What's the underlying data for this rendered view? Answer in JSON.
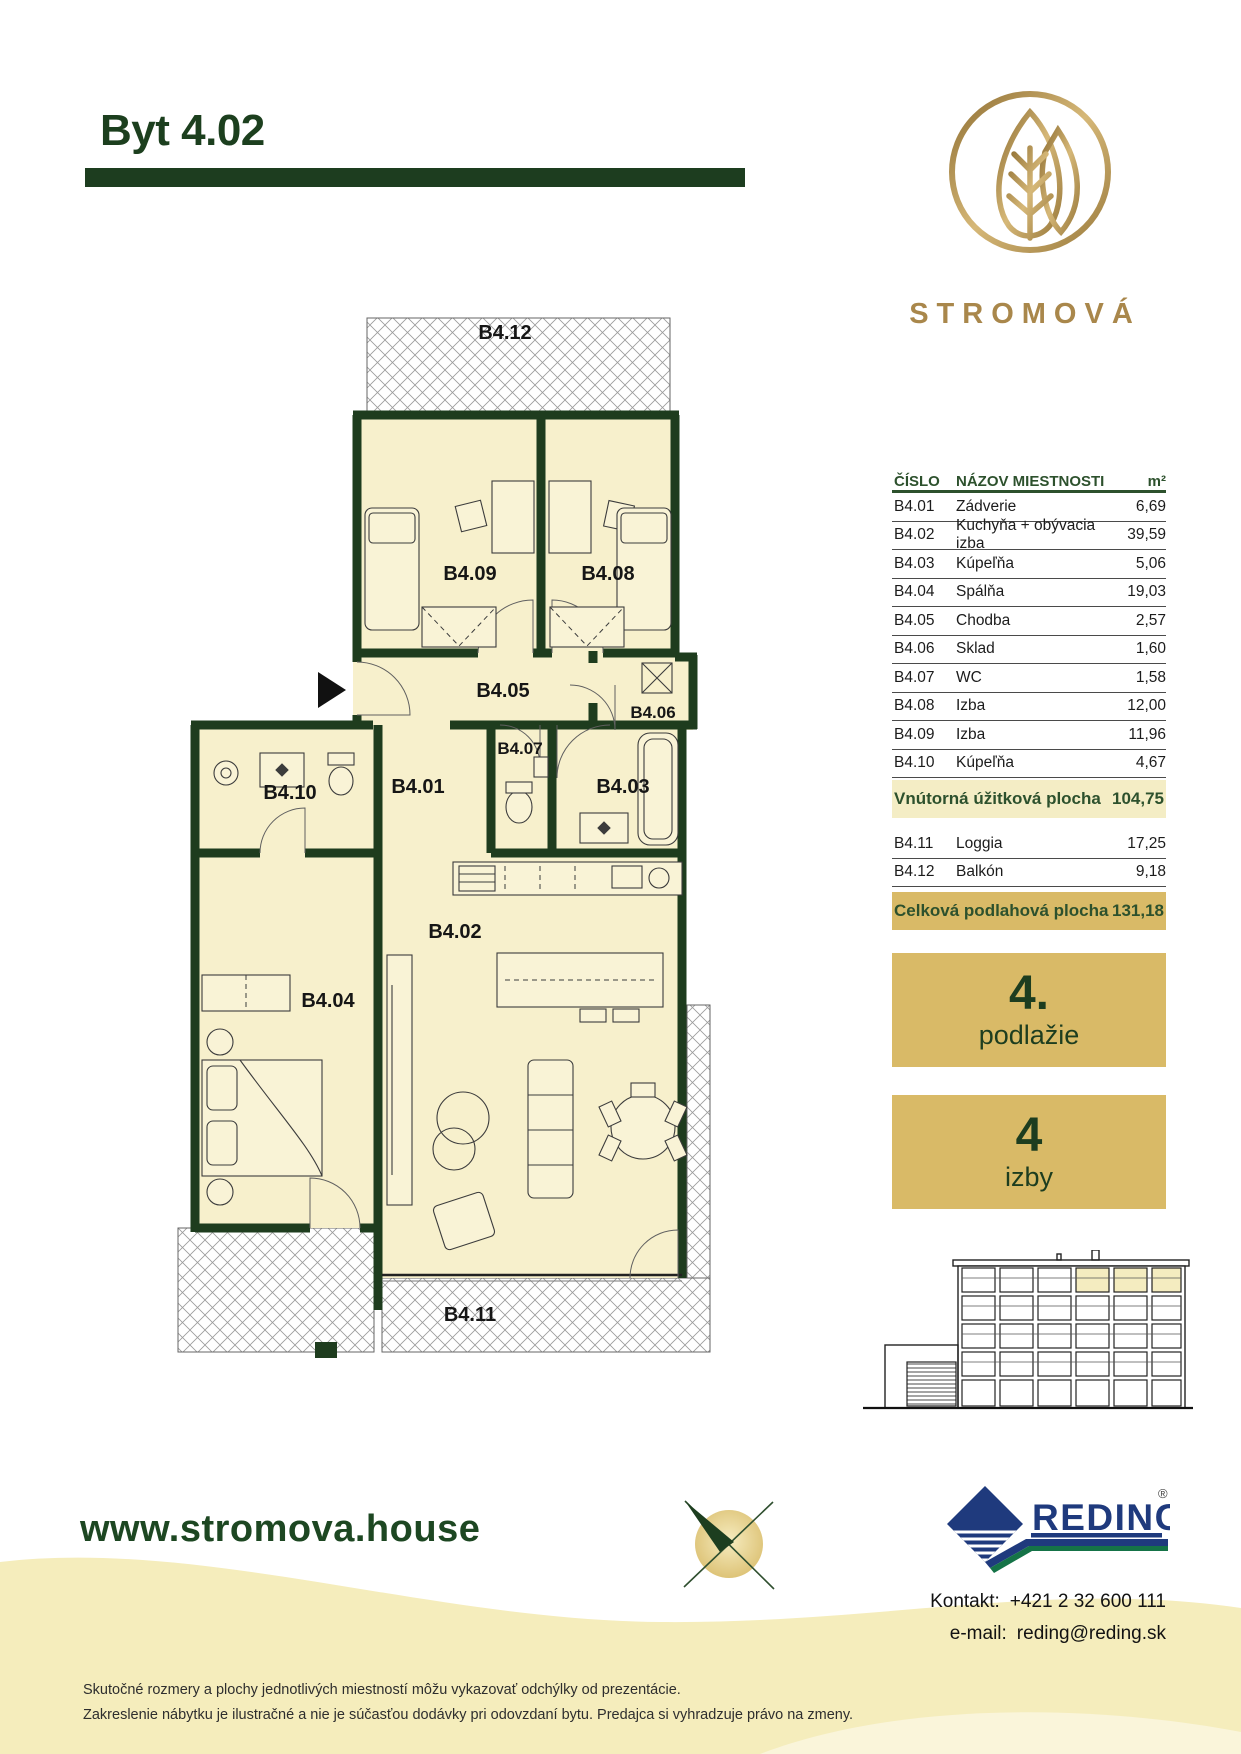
{
  "header": {
    "title": "Byt 4.02"
  },
  "brand": {
    "name": "STROMOVÁ"
  },
  "floorplan": {
    "rooms": {
      "r01": "B4.01",
      "r02": "B4.02",
      "r03": "B4.03",
      "r04": "B4.04",
      "r05": "B4.05",
      "r06": "B4.06",
      "r07": "B4.07",
      "r08": "B4.08",
      "r09": "B4.09",
      "r10": "B4.10",
      "r11": "B4.11",
      "r12": "B4.12"
    }
  },
  "table": {
    "headers": {
      "number": "ČÍSLO",
      "name": "NÁZOV MIESTNOSTI",
      "unit": "m²"
    },
    "rows": [
      {
        "no": "B4.01",
        "name": "Zádverie",
        "area": "6,69"
      },
      {
        "no": "B4.02",
        "name": "Kuchyňa + obývacia izba",
        "area": "39,59"
      },
      {
        "no": "B4.03",
        "name": "Kúpeľňa",
        "area": "5,06"
      },
      {
        "no": "B4.04",
        "name": "Spálňa",
        "area": "19,03"
      },
      {
        "no": "B4.05",
        "name": "Chodba",
        "area": "2,57"
      },
      {
        "no": "B4.06",
        "name": "Sklad",
        "area": "1,60"
      },
      {
        "no": "B4.07",
        "name": "WC",
        "area": "1,58"
      },
      {
        "no": "B4.08",
        "name": "Izba",
        "area": "12,00"
      },
      {
        "no": "B4.09",
        "name": "Izba",
        "area": "11,96"
      },
      {
        "no": "B4.10",
        "name": "Kúpeľňa",
        "area": "4,67"
      }
    ],
    "subtotal": {
      "label": "Vnútorná úžitková plocha",
      "value": "104,75"
    },
    "extra_rows": [
      {
        "no": "B4.11",
        "name": "Loggia",
        "area": "17,25"
      },
      {
        "no": "B4.12",
        "name": "Balkón",
        "area": "9,18"
      }
    ],
    "total": {
      "label": "Celková podlahová plocha",
      "value": "131,18"
    }
  },
  "badges": {
    "floor": {
      "value": "4.",
      "label": "podlažie"
    },
    "rooms": {
      "value": "4",
      "label": "izby"
    }
  },
  "footer": {
    "website": "www.stromova.house",
    "partner": "REDING",
    "registered": "®",
    "contact_label": "Kontakt:",
    "contact_phone": "+421 2 32 600 111",
    "email_label": "e-mail:",
    "email": "reding@reding.sk",
    "disclaimer_line1": "Skutočné rozmery a plochy jednotlivých miestností môžu vykazovať odchýlky od prezentácie.",
    "disclaimer_line2": "Zakreslenie nábytku je ilustračné a nie je súčasťou dodávky pri odovzdaní bytu. Predajca si vyhradzuje právo na zmeny."
  },
  "colors": {
    "dark_green": "#1e3c1e",
    "gold": "#d9ba67",
    "pale_yellow": "#f5edbc",
    "navy": "#1f3a7d",
    "reding_green": "#157347",
    "logo_gold": "#a9874b"
  }
}
